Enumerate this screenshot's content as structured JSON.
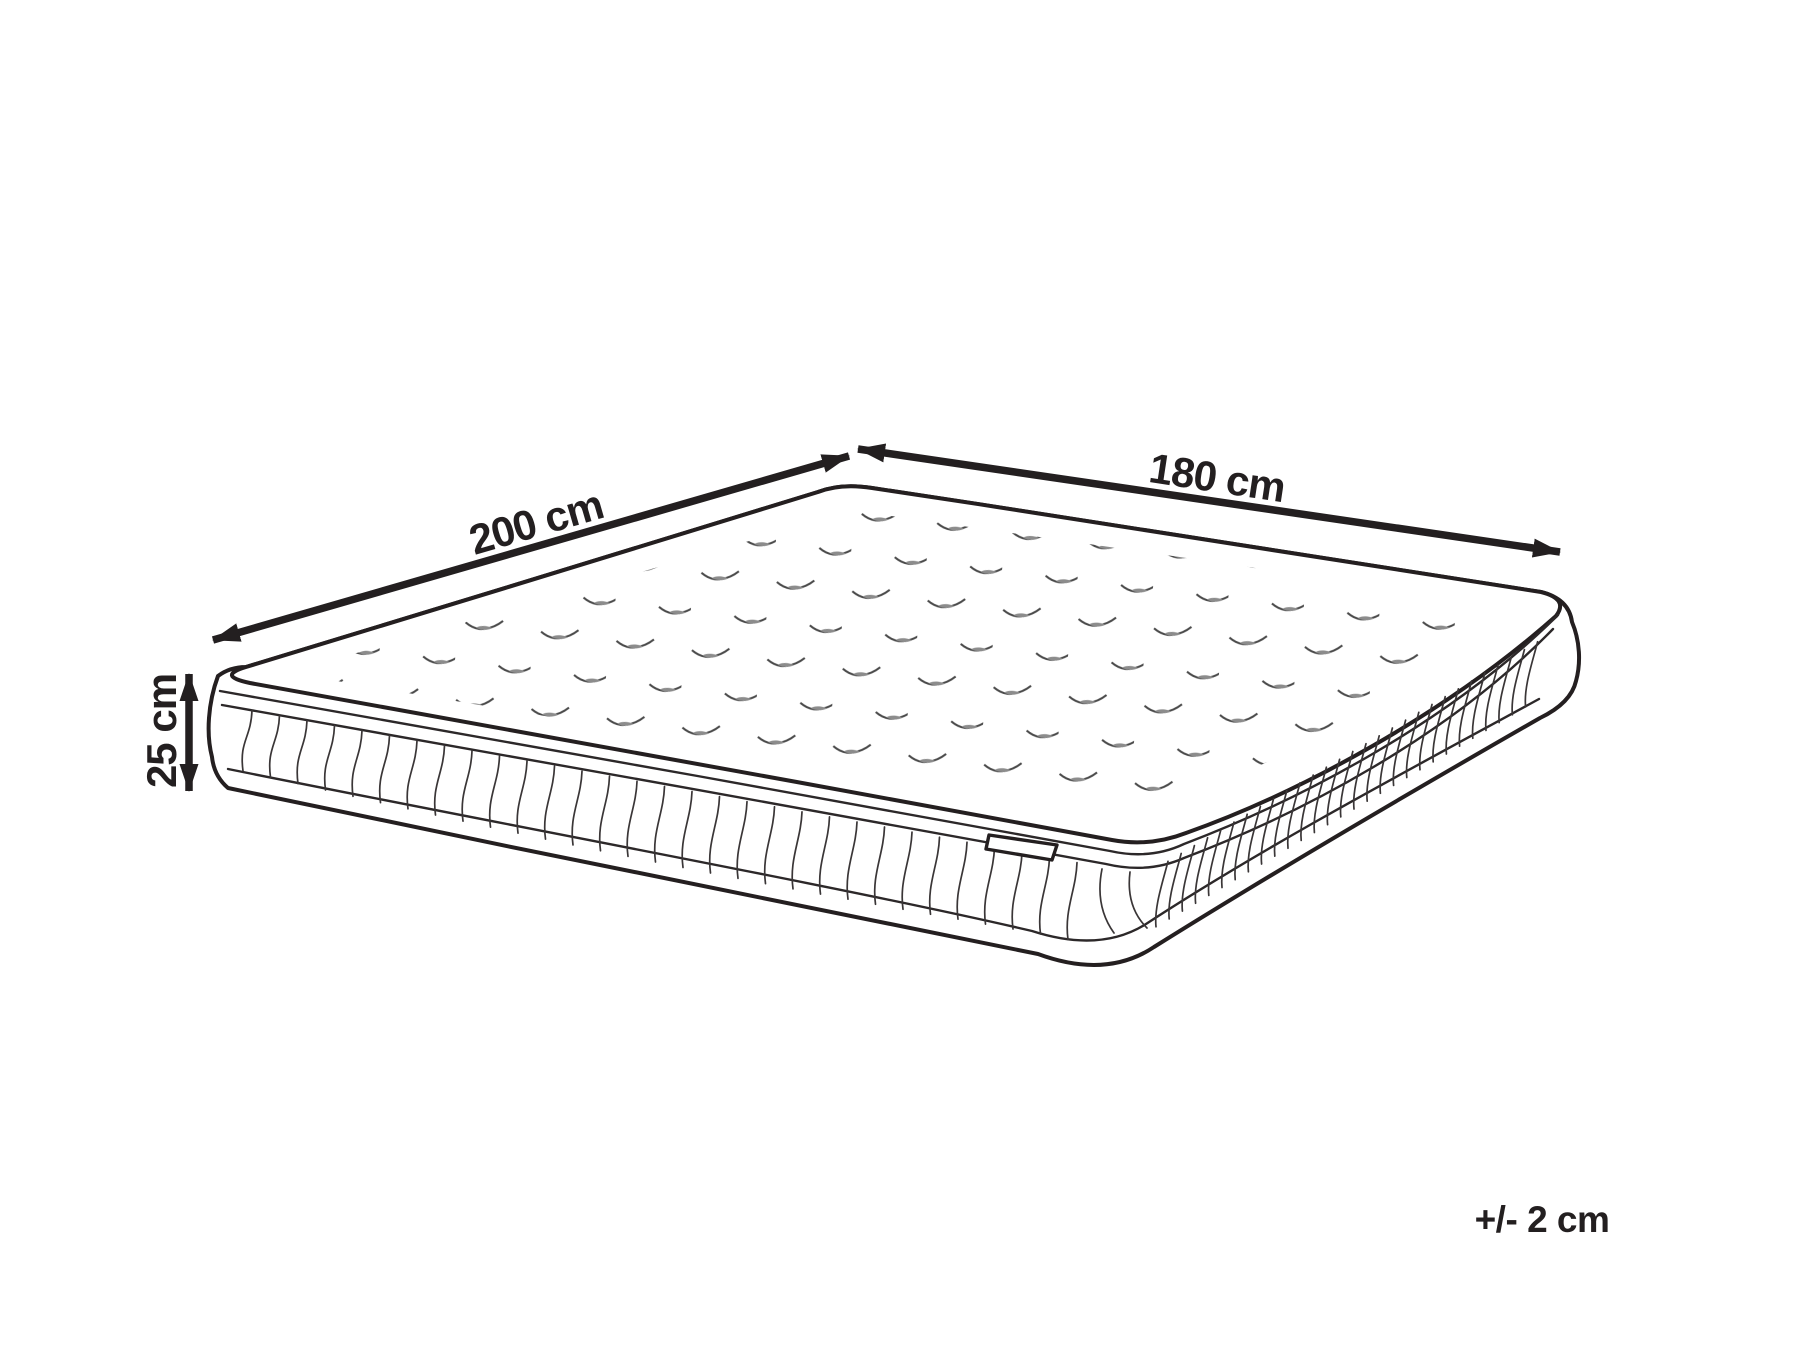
{
  "diagram": {
    "labels": {
      "length": "200 cm",
      "width": "180 cm",
      "height": "25 cm",
      "tolerance": "+/- 2 cm"
    },
    "colors": {
      "line": "#231f20",
      "background": "#ffffff"
    }
  }
}
